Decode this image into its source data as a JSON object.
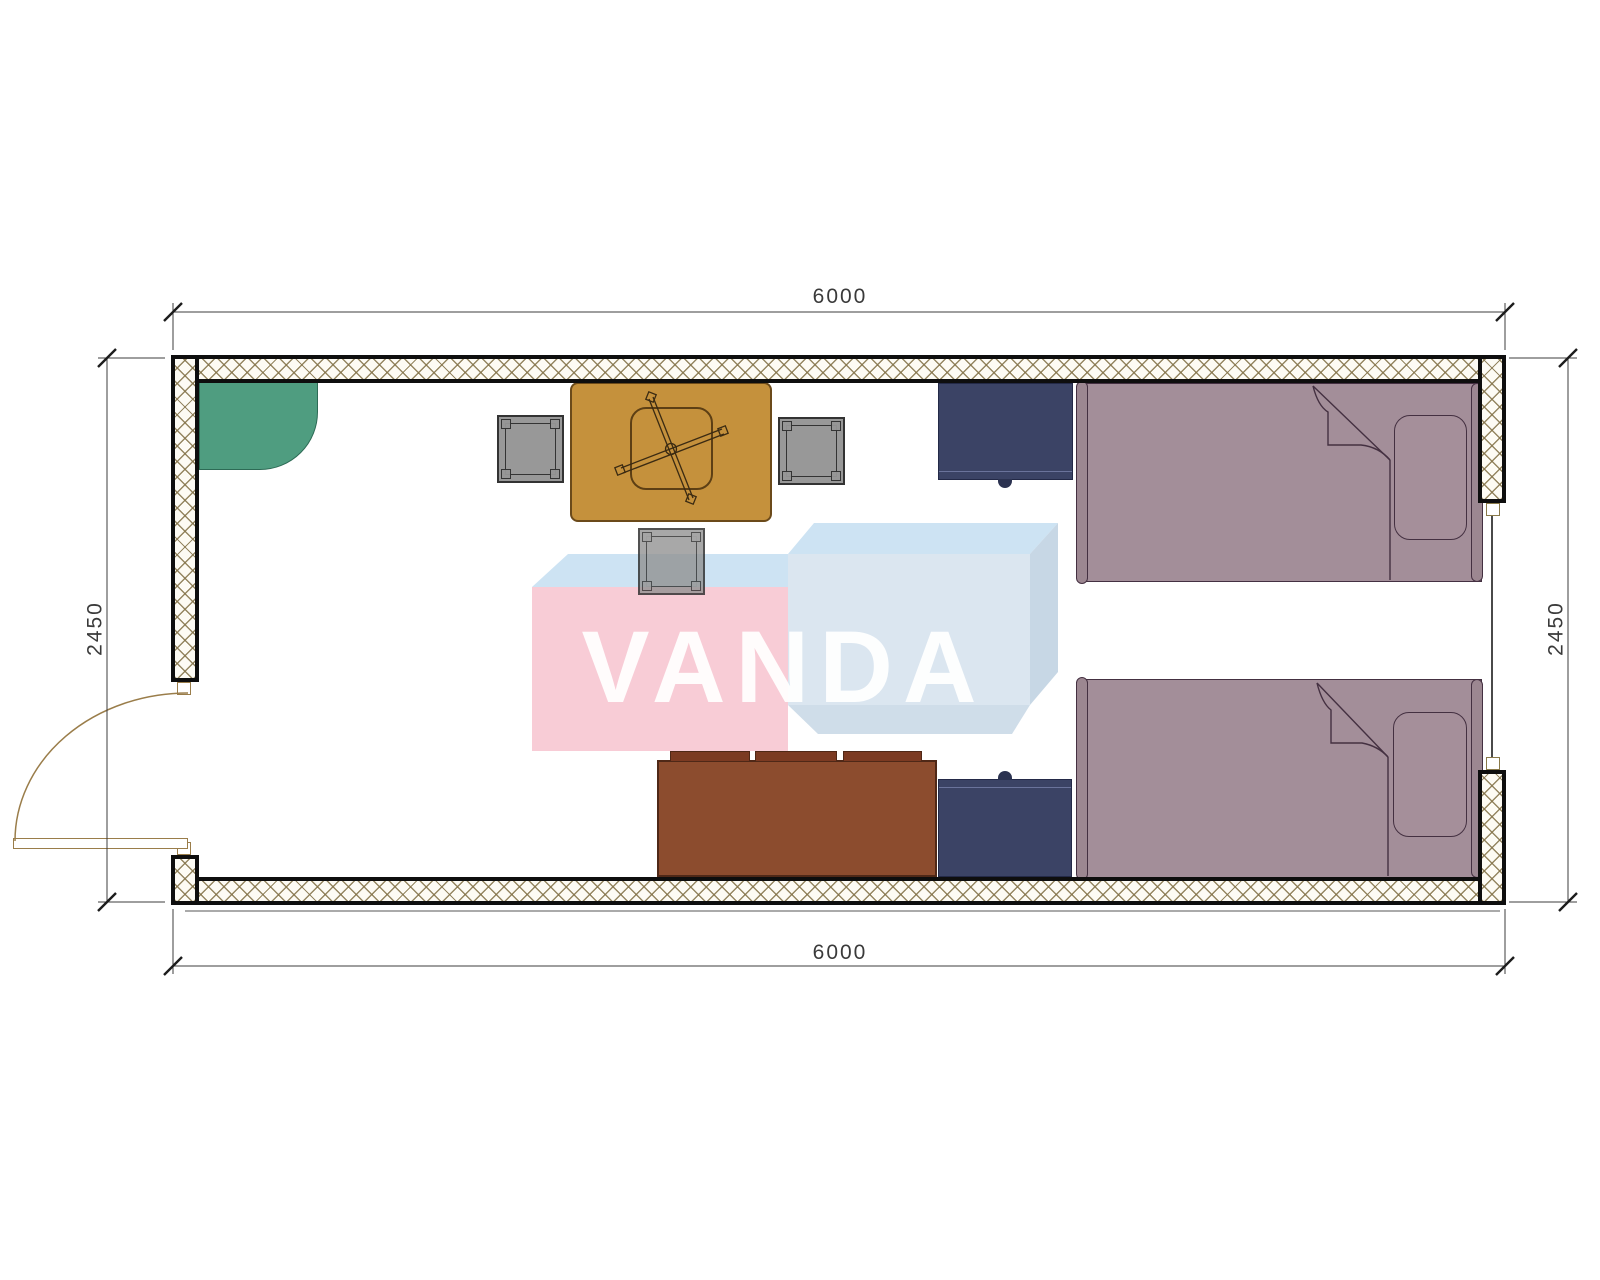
{
  "drawing": {
    "type": "floor-plan",
    "description": "Top view plan of a 6000 x 2450 mm container cabin with two single beds, two nightstands, sofa, dining table with three stools, corner shelf, one door and one window",
    "room": {
      "width_mm": 6000,
      "depth_mm": 2450
    }
  },
  "dimensions": {
    "top": "6000",
    "bottom": "6000",
    "left": "2450",
    "right": "2450"
  },
  "watermark": {
    "text": "VANDA",
    "pink": "#f8ccd6",
    "light_blue": "#cde3f3",
    "front_blue": "#dbe6f0",
    "side_blue": "#c7d7e5"
  },
  "colors": {
    "wall_hatch_line": "#837248",
    "wall_border": "#0e0e0e",
    "corner_shelf_green": "#4f9d80",
    "table_tan": "#c5913c",
    "stool_gray": "#8f8f8f",
    "nightstand_navy": "#3b4365",
    "bed_mauve": "#a38e99",
    "sofa_brown": "#8c4c2e",
    "door_line_tan": "#9a7d4a",
    "dimension_text": "#3a3a3a"
  },
  "furniture": [
    "corner-shelf",
    "dining-table",
    "stool-left",
    "stool-right",
    "stool-bottom",
    "nightstand-top",
    "nightstand-bottom",
    "bed-top",
    "bed-bottom",
    "sofa",
    "door",
    "window"
  ]
}
